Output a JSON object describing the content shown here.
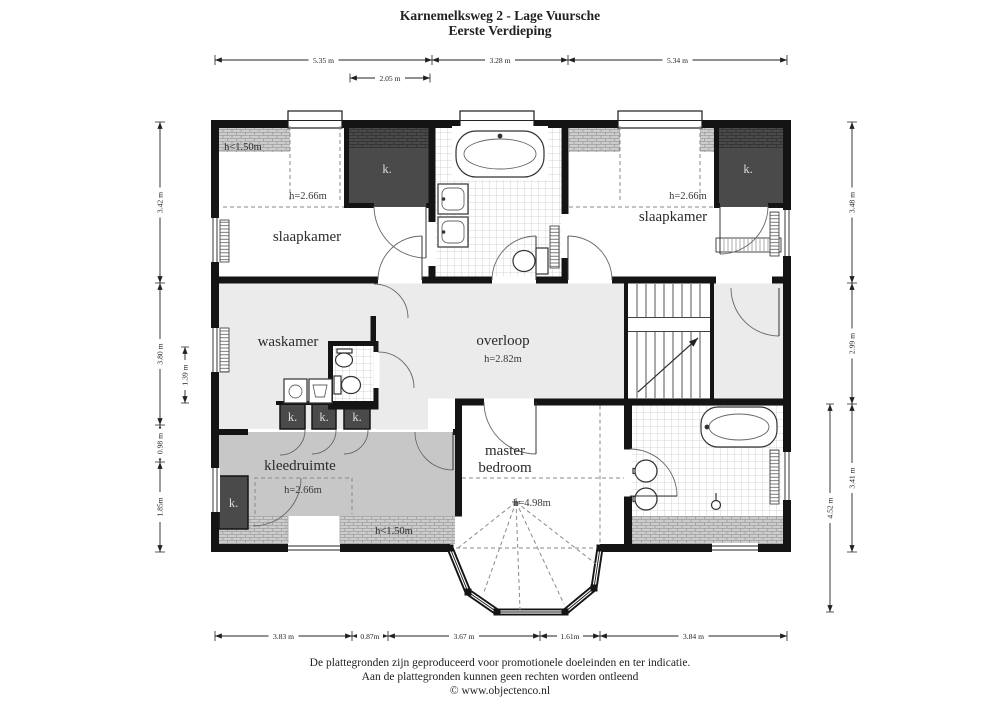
{
  "title": {
    "line1": "Karnemelksweg 2 - Lage Vuursche",
    "line2": "Eerste Verdieping"
  },
  "rooms": {
    "slaapkamer_left": {
      "name": "slaapkamer",
      "ceiling": "h=2.66m"
    },
    "slaapkamer_right": {
      "name": "slaapkamer",
      "ceiling": "h=2.66m"
    },
    "waskamer": {
      "name": "waskamer"
    },
    "overloop": {
      "name": "overloop",
      "ceiling": "h=2.82m"
    },
    "master_bedroom": {
      "name_line1": "master",
      "name_line2": "bedroom",
      "ceiling": "h=4.98m"
    },
    "kleedruimte": {
      "name": "kleedruimte",
      "ceiling": "h=2.66m"
    },
    "closet_label": "k.",
    "low_ceiling": "h<1.50m"
  },
  "dimensions": {
    "top": [
      "5.35 m",
      "3.28 m",
      "5.34 m"
    ],
    "top_sub": "2.05 m",
    "bottom": [
      "3.83 m",
      "0.87m",
      "3.67 m",
      "1.61m",
      "3.84 m"
    ],
    "left": [
      "3.42 m",
      "3.80 m",
      "0.98 m",
      "1.85m"
    ],
    "left_inner": "1.39 m",
    "right": [
      "3.48 m",
      "2.99 m",
      "3.41 m"
    ],
    "right_outer": "4.52 m"
  },
  "footer": {
    "line1": "De plattegronden zijn geproduceerd voor promotionele doeleinden en ter indicatie.",
    "line2": "Aan de plattegronden kunnen geen rechten worden ontleend",
    "line3": "© www.objectenco.nl"
  },
  "colors": {
    "wall": "#141414",
    "closet": "#4a4a4a",
    "floor_light": "#ebebeb",
    "floor_mid": "#c7c7c7",
    "hatch": "#cdcdcd",
    "tile_line": "#c9c9c9",
    "dim_text": "#222222"
  }
}
